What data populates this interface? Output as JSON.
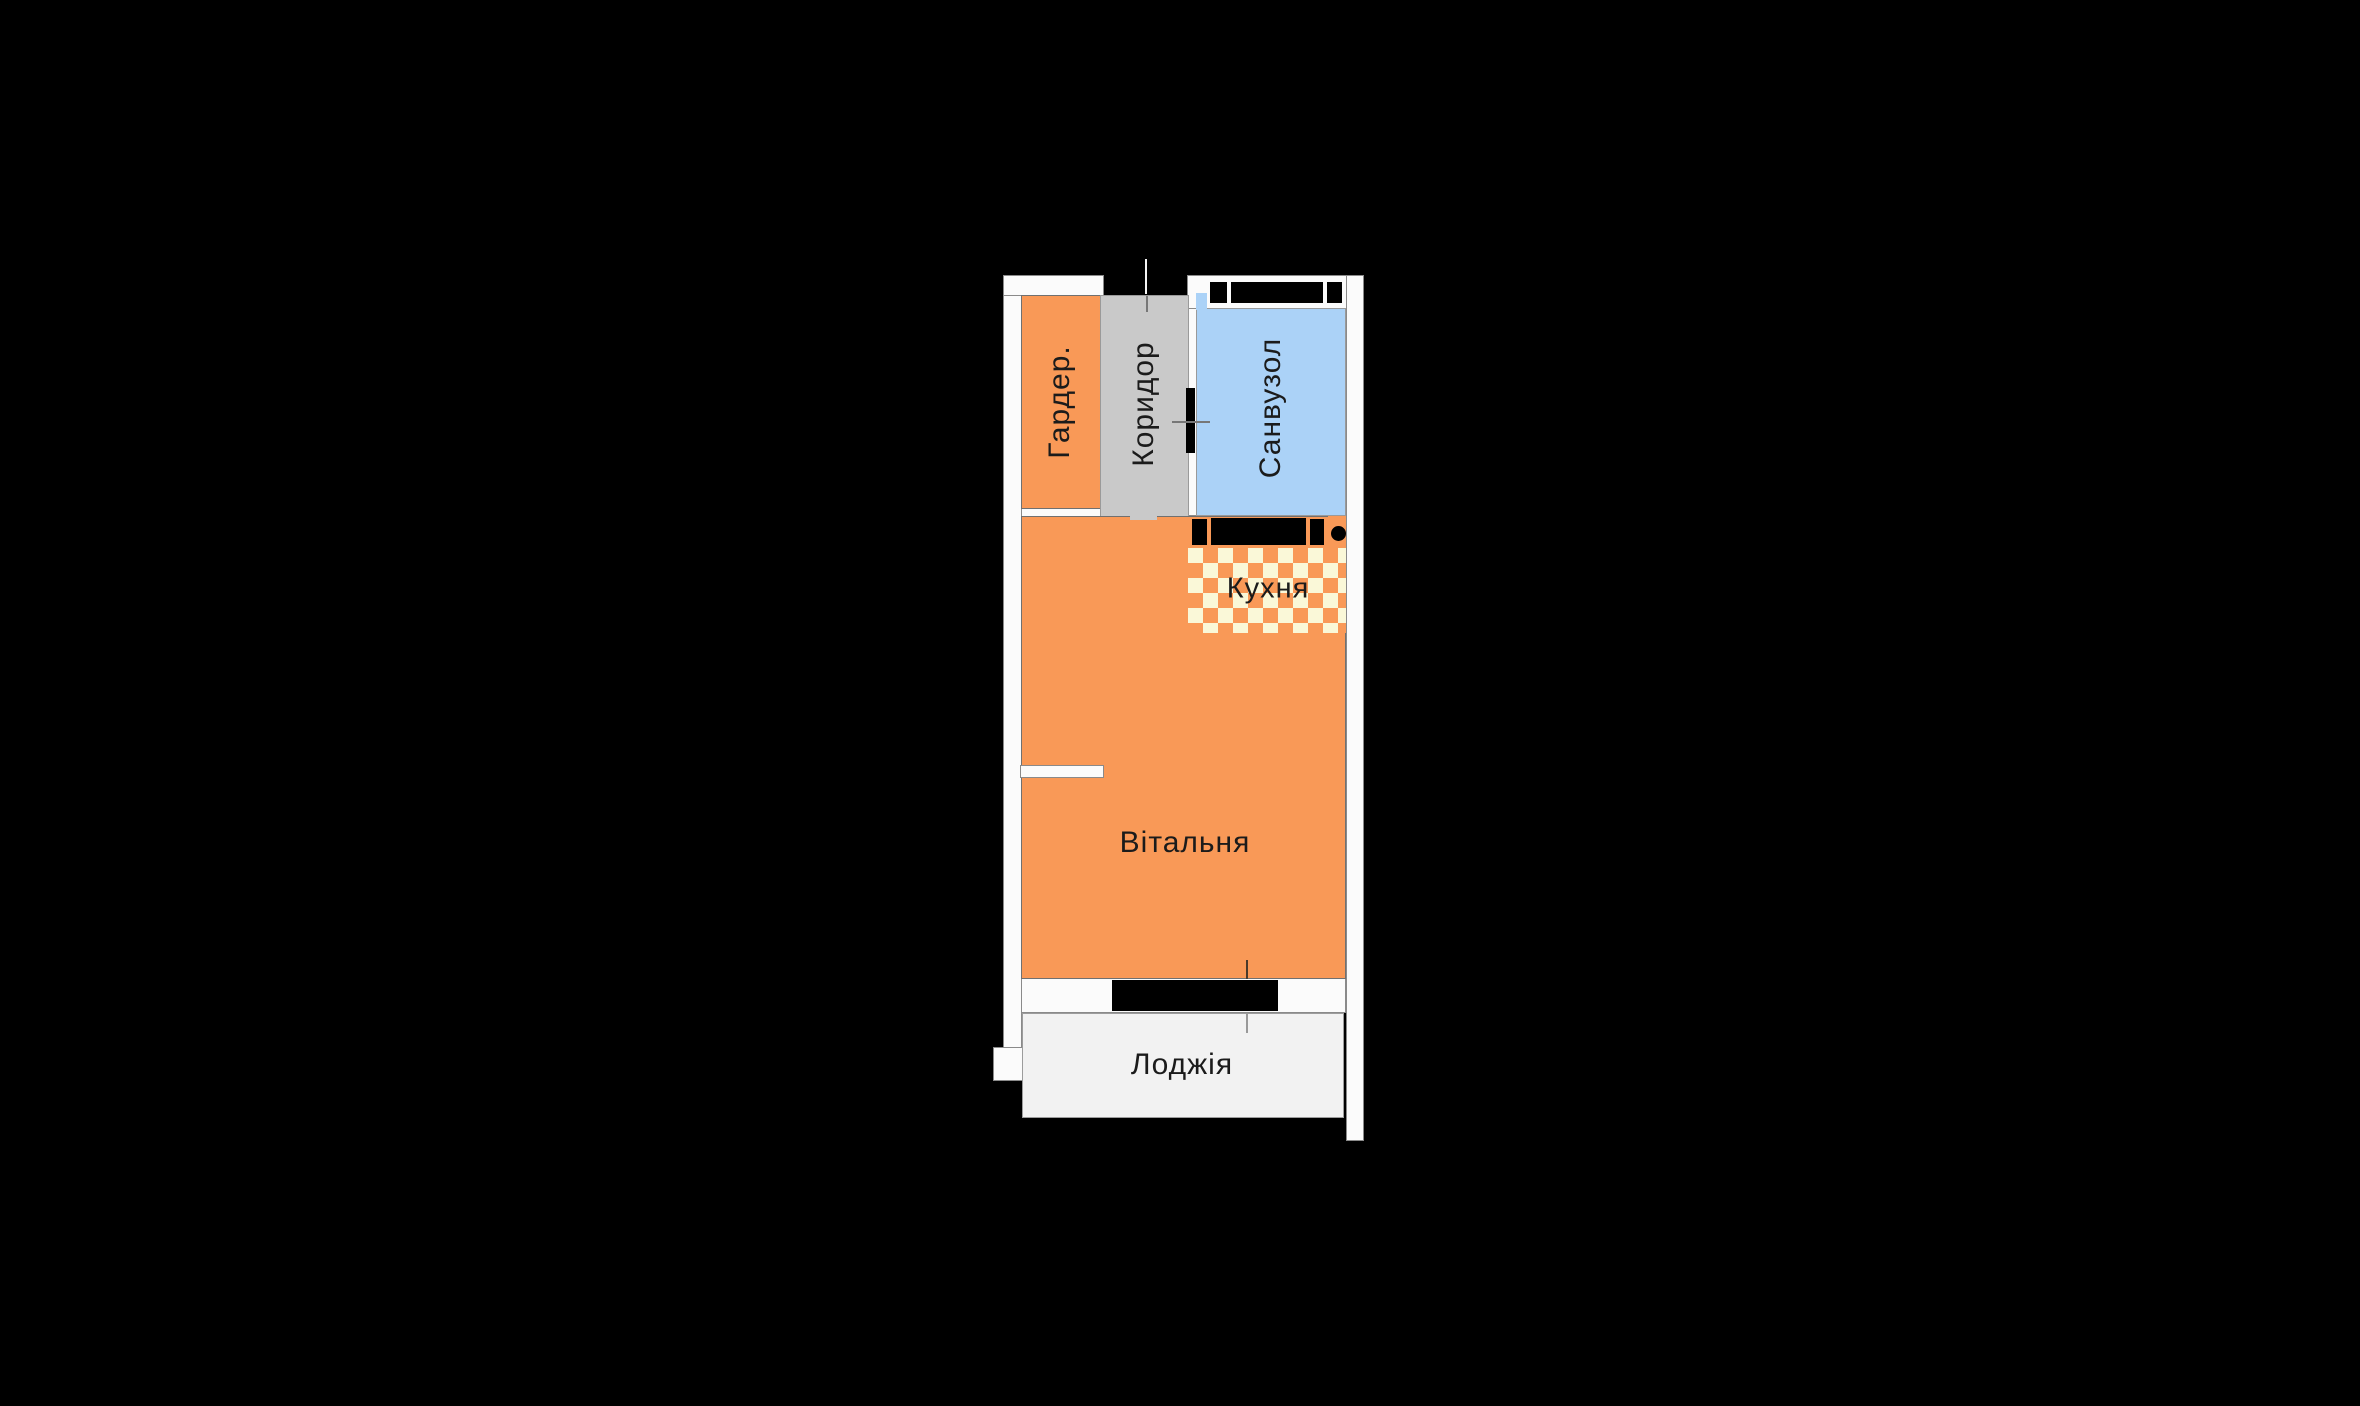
{
  "title": "Apartment floor plan",
  "colors": {
    "background": "#000000",
    "wall": "#fbfbfb",
    "wall_border": "#8a8a8a",
    "room_orange": "#f99957",
    "room_border": "#707070",
    "corridor_gray": "#c9c9c9",
    "corridor_border": "#9a9a9a",
    "bathroom_blue": "#abd2f7",
    "kitchen_cream": "#faf8d8",
    "loggia_gray": "#f2f2f2",
    "loggia_border": "#9c9c9c",
    "black_element": "#000000",
    "label_text": "#1b1b1b"
  },
  "rooms": {
    "wardrobe": {
      "label": "Гардер.",
      "orientation": "vertical",
      "fill": "#f99957"
    },
    "corridor": {
      "label": "Коридор",
      "orientation": "vertical",
      "fill": "#c9c9c9"
    },
    "bathroom": {
      "label": "Санвузол",
      "orientation": "vertical",
      "fill": "#abd2f7"
    },
    "kitchen": {
      "label": "Кухня",
      "orientation": "horizontal",
      "fill": "checker-orange-cream"
    },
    "living_room": {
      "label": "Вітальня",
      "orientation": "horizontal",
      "fill": "#f99957"
    },
    "loggia": {
      "label": "Лоджія",
      "orientation": "horizontal",
      "fill": "#f2f2f2"
    }
  }
}
